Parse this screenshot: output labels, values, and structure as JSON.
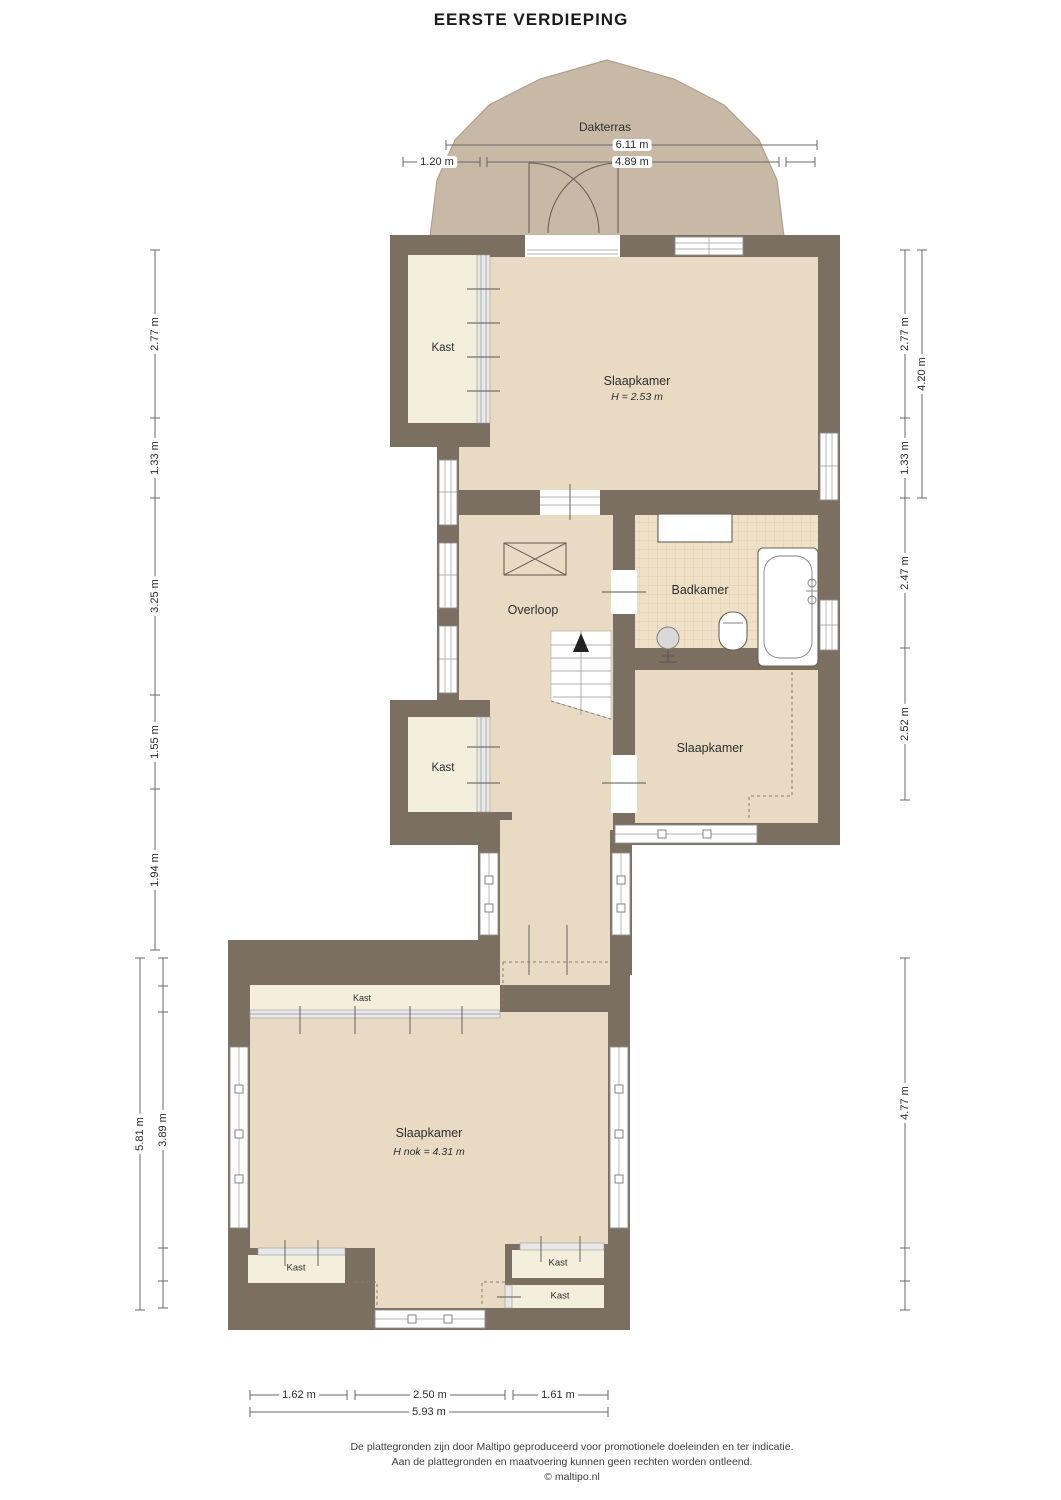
{
  "title": "EERSTE VERDIEPING",
  "terrace": {
    "label": "Dakterras"
  },
  "rooms": {
    "kast_top": {
      "label": "Kast"
    },
    "slaapkamer_top": {
      "label": "Slaapkamer",
      "height": "H = 2.53 m"
    },
    "overloop": {
      "label": "Overloop"
    },
    "badkamer": {
      "label": "Badkamer"
    },
    "slaapkamer_mid": {
      "label": "Slaapkamer"
    },
    "kast_mid": {
      "label": "Kast"
    },
    "slaapkamer_bottom": {
      "label": "Slaapkamer",
      "height": "H nok = 4.31 m"
    },
    "kast_strip": {
      "label": "Kast"
    },
    "kast_bottom_left": {
      "label": "Kast"
    },
    "kast_bottom_right_1": {
      "label": "Kast"
    },
    "kast_bottom_right_2": {
      "label": "Kast"
    }
  },
  "dimensions": {
    "terrace_width": "6.11 m",
    "terrace_left": "1.20 m",
    "terrace_inner": "4.89 m",
    "left_upper": [
      "2.77 m",
      "1.33 m",
      "3.25 m",
      "1.55 m",
      "1.94 m"
    ],
    "left_lower_total": "5.81 m",
    "left_lower_inner": "3.89 m",
    "right_upper": [
      "2.77 m",
      "1.33 m",
      "2.47 m",
      "2.52 m"
    ],
    "right_upper_total": "4.20 m",
    "right_lower": "4.77 m",
    "bottom_segments": [
      "1.62 m",
      "2.50 m",
      "1.61 m"
    ],
    "bottom_total": "5.93 m"
  },
  "footer": {
    "line1": "De plattegronden zijn door Maltipo geproduceerd voor promotionele doeleinden en ter indicatie.",
    "line2": "Aan de plattegronden en maatvoering kunnen geen rechten worden ontleend.",
    "line3": "© maltipo.nl"
  },
  "colors": {
    "wall": "#7b6f62",
    "floor": "#e9dbc3",
    "closet": "#f4eedc",
    "terrace": "#c7b9a6",
    "terrace_border": "#b0a18d",
    "tile": "#efe1c8",
    "tile_line": "#dcc7a6",
    "dim_line": "#686868",
    "label_text": "#2e2e2e"
  }
}
